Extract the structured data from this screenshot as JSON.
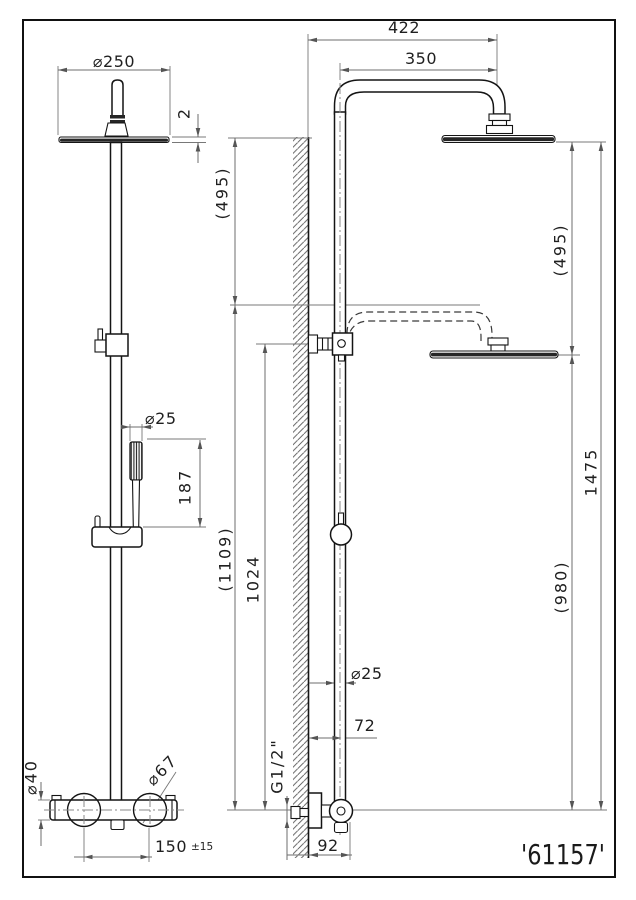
{
  "title_block": {
    "part_number": "'61157'"
  },
  "front_view": {
    "dims": {
      "head_diameter": "⌀250",
      "head_thickness": "2",
      "handshower_diameter": "⌀25",
      "handshower_length": "187",
      "overall_drop": "(1109)",
      "valve_body_diameter": "⌀40",
      "escutcheon_diameter": "⌀67",
      "hose_centers": "150",
      "hose_centers_tolerance": "±15"
    }
  },
  "side_view": {
    "dims": {
      "arm_reach_wall": "422",
      "arm_reach_pipe": "350",
      "head_drop_left": "(495)",
      "head_drop_right": "(495)",
      "total_height": "1475",
      "lowered_height": "(980)",
      "rail_length": "1024",
      "pipe_diameter": "⌀25",
      "wall_to_pipe": "72",
      "inlet_thread": "G1/2\"",
      "wall_to_elbow": "92"
    }
  }
}
